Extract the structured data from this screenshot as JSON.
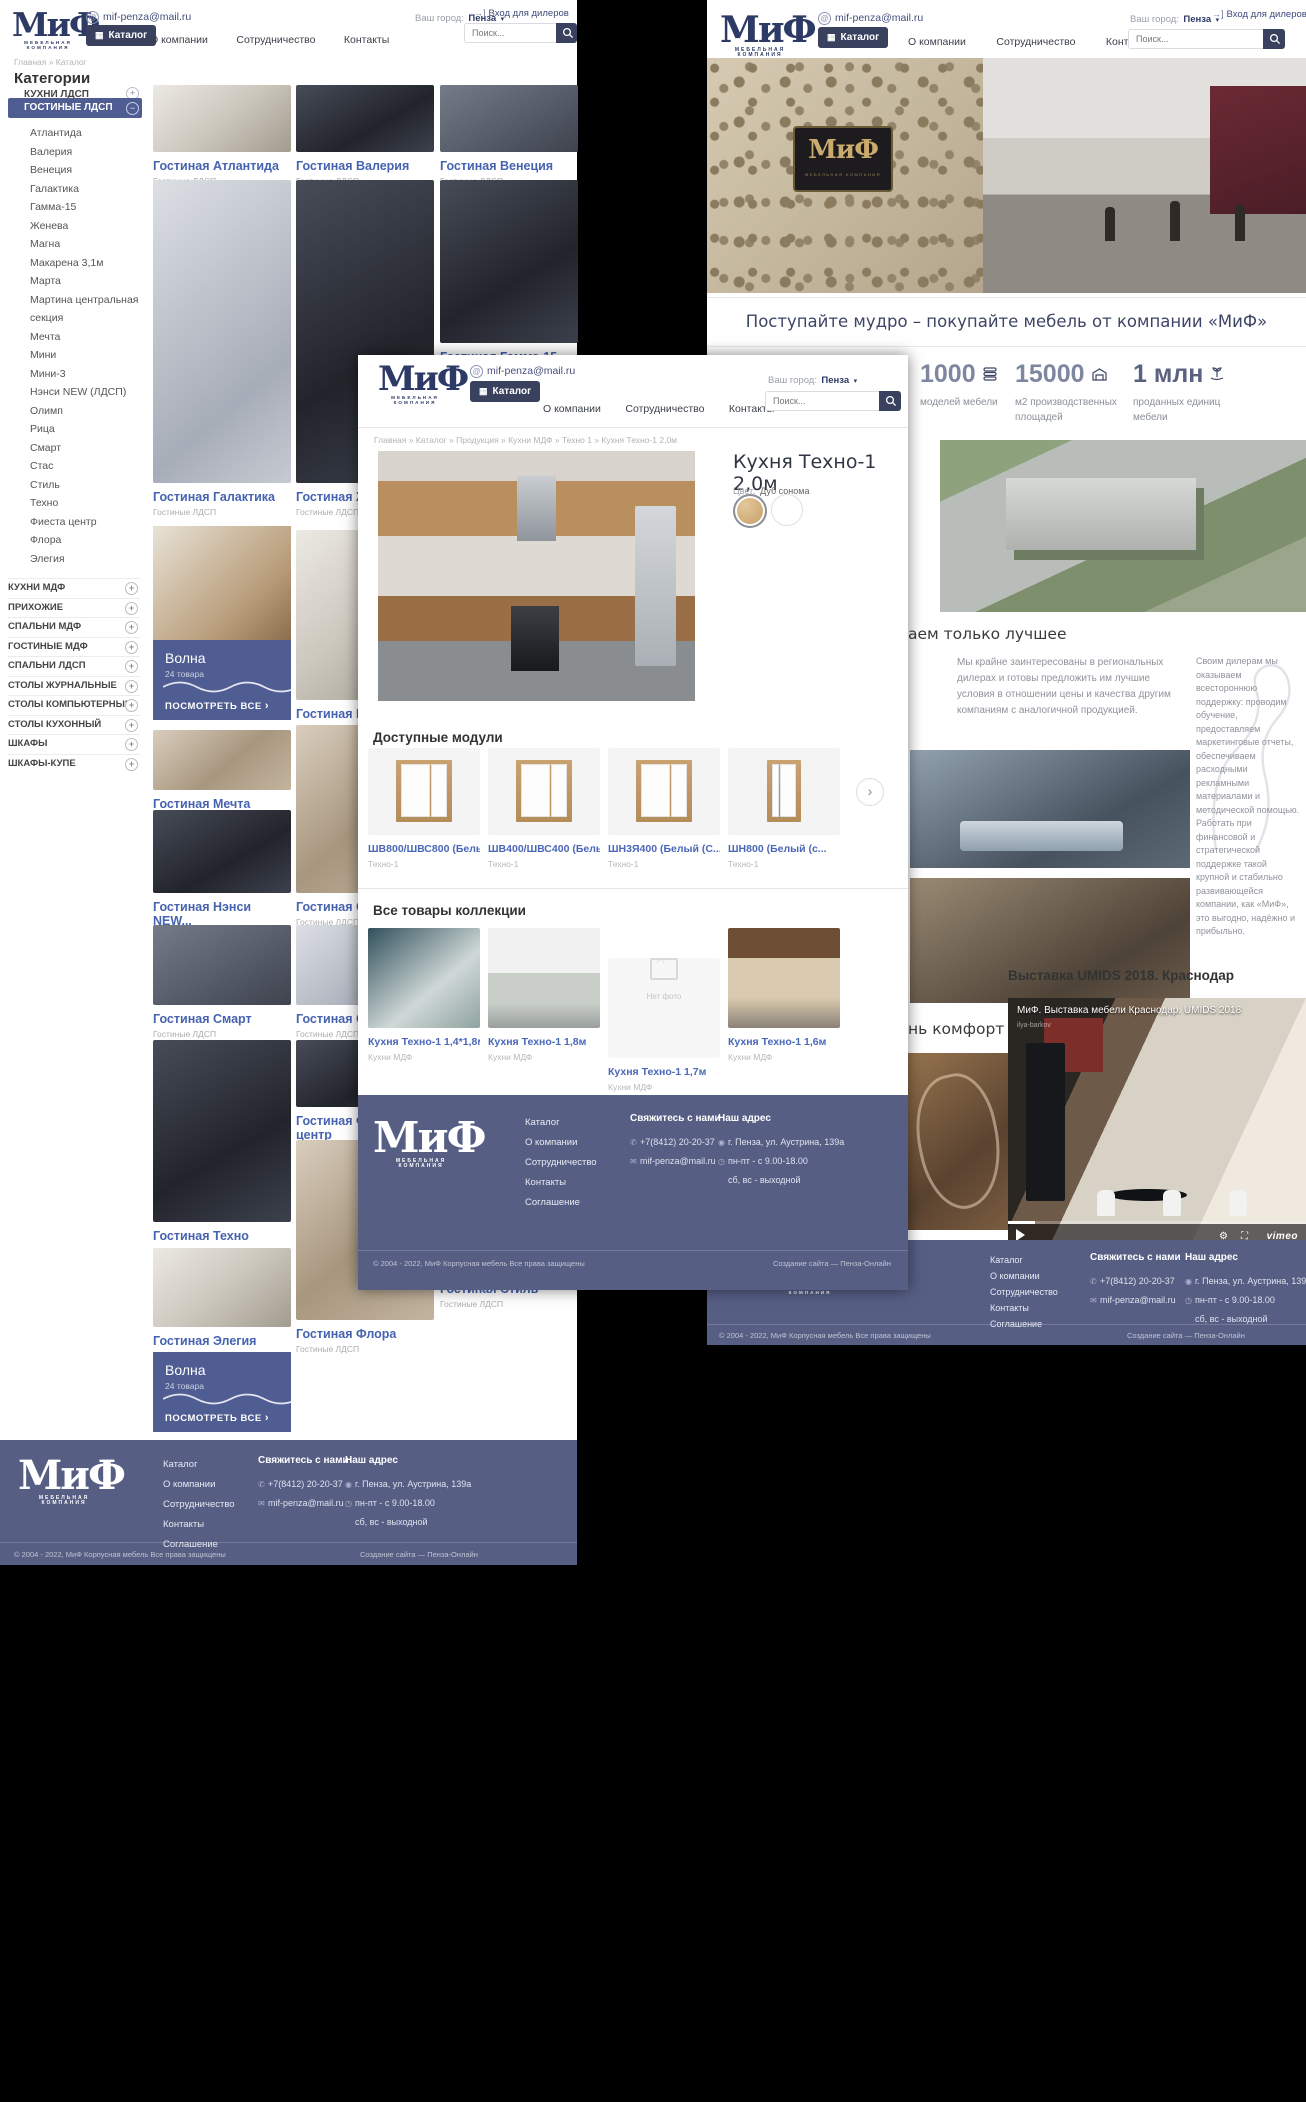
{
  "shared": {
    "logo": {
      "word": "МиФ",
      "sub": "МЕБЕЛЬНАЯ  КОМПАНИЯ"
    },
    "header": {
      "email": "mif-penza@mail.ru",
      "catalog_button": "Каталог",
      "nav": [
        "О компании",
        "Сотрудничество",
        "Контакты"
      ],
      "city_label": "Ваш город:",
      "city": "Пенза",
      "dealers_link": "Вход для дилеров",
      "search_placeholder": "Поиск..."
    },
    "footer": {
      "links": [
        "Каталог",
        "О компании",
        "Сотрудничество",
        "Контакты",
        "Соглашение"
      ],
      "contact_heading": "Свяжитесь с нами",
      "phone": "+7(8412) 20-20-37",
      "email": "mif-penza@mail.ru",
      "address_heading": "Наш адрес",
      "address": "г. Пенза, ул. Аустрина, 139а",
      "hours1": "пн-пт - с 9.00-18.00",
      "hours2": "сб, вс - выходной",
      "copyright": "© 2004 - 2022, МиФ Корпусная мебель Все права защищены",
      "credits": "Создание сайта — Пенза-Онлайн"
    }
  },
  "catalog_page": {
    "breadcrumb": "Главная » Каталог",
    "title": "Категории",
    "sidebar": {
      "first_item": "КУХНИ ЛДСП",
      "selected_item": "ГОСТИНЫЕ ЛДСП",
      "sub_items": [
        "Атлантида",
        "Валерия",
        "Венеция",
        "Галактика",
        "Гамма-15",
        "Женева",
        "Магна",
        "Макарена 3,1м",
        "Марта",
        "Мартина центральная секция",
        "Мечта",
        "Мини",
        "Мини-3",
        "Нэнси NEW (ЛДСП)",
        "Олимп",
        "Рица",
        "Смарт",
        "Стас",
        "Стиль",
        "Техно",
        "Фиеста центр",
        "Флора",
        "Элегия"
      ],
      "accordion_items": [
        "КУХНИ МДФ",
        "ПРИХОЖИЕ",
        "СПАЛЬНИ МДФ",
        "ГОСТИНЫЕ МДФ",
        "СПАЛЬНИ ЛДСП",
        "СТОЛЫ ЖУРНАЛЬНЫЕ",
        "СТОЛЫ КОМПЬЮТЕРНЫЕ",
        "СТОЛЫ КУХОННЫЙ",
        "ШКАФЫ",
        "ШКАФЫ-КУПЕ"
      ]
    },
    "col1": [
      {
        "name": "Гостиная Атлантида",
        "cat": "Гостиные ЛДСП",
        "top": 0,
        "h": 67,
        "ph": "ph-c"
      },
      {
        "name": "Гостиная Галактика",
        "cat": "Гостиные ЛДСП",
        "top": 95,
        "h": 303,
        "ph": "ph-f"
      },
      {
        "name": "Гостиная Мечта",
        "cat": "Гостиные ЛДСП",
        "top": 645,
        "h": 60,
        "ph": "ph-a"
      },
      {
        "name": "Гостиная Нэнси NEW...",
        "cat": "Гостиные ЛДСП",
        "top": 725,
        "h": 83,
        "ph": "ph-b"
      },
      {
        "name": "Гостиная Смарт",
        "cat": "Гостиные ЛДСП",
        "top": 840,
        "h": 80,
        "ph": "ph-d"
      },
      {
        "name": "Гостиная Техно",
        "cat": "Гостиные ЛДСП",
        "top": 955,
        "h": 182,
        "ph": "ph-b"
      },
      {
        "name": "Гостиная Элегия",
        "cat": "Гостиные ЛДСП",
        "top": 1163,
        "h": 79,
        "ph": "ph-c"
      }
    ],
    "col2": [
      {
        "name": "Гостиная Валерия",
        "cat": "Гостиные ЛДСП",
        "top": 0,
        "h": 67,
        "ph": "ph-b"
      },
      {
        "name": "Гостиная Женева",
        "cat": "Гостиные ЛДСП",
        "top": 95,
        "h": 303,
        "ph": "ph-b"
      },
      {
        "name": "Гостиная Магна",
        "cat": "Гостиные ЛДСП",
        "top": 445,
        "h": 170,
        "ph": "ph-c"
      },
      {
        "name": "Гостиная Олимп",
        "cat": "Гостиные ЛДСП",
        "top": 640,
        "h": 168,
        "ph": "ph-a"
      },
      {
        "name": "Гостиная Стас",
        "cat": "Гостиные ЛДСП",
        "top": 840,
        "h": 80,
        "ph": "ph-f"
      },
      {
        "name": "Гостиная Фиеста центр",
        "cat": "Гостиные ЛДСП",
        "top": 955,
        "h": 67,
        "ph": "ph-b"
      },
      {
        "name": "Гостиная Флора",
        "cat": "Гостиные ЛДСП",
        "top": 1055,
        "h": 180,
        "ph": "ph-a"
      }
    ],
    "col3": [
      {
        "name": "Гостиная Венеция",
        "cat": "Гостиные ЛДСП",
        "top": 0,
        "h": 67,
        "ph": "ph-d"
      },
      {
        "name": "Гостиная Гамма-15",
        "cat": "Гостиные ЛДСП",
        "top": 95,
        "h": 163,
        "ph": "ph-b"
      },
      {
        "name": "Гостиная Макарена 3,1м",
        "cat": "Гостиные ЛДСП",
        "top": 293,
        "h": 120,
        "ph": "ph-c"
      },
      {
        "name": "Гостиная Марта",
        "cat": "Гостиные ЛДСП",
        "top": 440,
        "h": 150,
        "ph": "ph-a"
      },
      {
        "name": "Гостиная Мини",
        "cat": "Гостиные ЛДСП",
        "top": 620,
        "h": 140,
        "ph": "ph-f"
      },
      {
        "name": "Гостиная Мини-3",
        "cat": "Гостиные ЛДСП",
        "top": 790,
        "h": 140,
        "ph": "ph-c"
      },
      {
        "name": "Гостиная Рица",
        "cat": "Гостиные ЛДСП",
        "top": 960,
        "h": 140,
        "ph": "ph-b"
      },
      {
        "name": "Гостиная Стиль",
        "cat": "Гостиные ЛДСП",
        "top": 1130,
        "h": 60,
        "ph": "ph-d"
      }
    ],
    "promo": {
      "title": "Волна",
      "count": "24 товара",
      "cta": "ПОСМОТРЕТЬ ВСЕ",
      "cta_arrow": "›"
    }
  },
  "home_page": {
    "headline": "Поступайте мудро – покупайте мебель от компании «МиФ»",
    "stats": [
      {
        "value": "1000",
        "label": "моделей мебели"
      },
      {
        "value": "15000",
        "label": "м2 производственных площадей"
      },
      {
        "value": "1 млн",
        "label": "проданных единиц мебели"
      }
    ],
    "section1_heading_visible": "аем только лучшее",
    "para1": "Мы крайне заинтересованы в региональных дилерах и готовы предложить им лучшие условия в отношении цены и качества другим компаниям с аналогичной продукцией.",
    "para2": "Своим дилерам мы оказываем всестороннюю поддержку: проводим обучение, предоставляем маркетинговые отчеты, обеспечиваем расходными рекламными материалами и методической помощью. Работать при финансовой и стратегической поддержке такой крупной и стабильно развивающейся компании, как «МиФ», это выгодно, надёжно и прибыльно.",
    "section2_heading_visible": "нь комфортной, красивой и уютной!",
    "video_heading": "Выставка UMIDS 2018. Краснодар",
    "video_title": "МиФ. Выставка мебели Краснодар. UMIDS 2018",
    "video_watermark": "ilya-barkov",
    "vimeo_label": "vimeo"
  },
  "product_page": {
    "breadcrumb": "Главная » Каталог » Продукция » Кухни МДФ » Техно 1 » Кухня Техно-1 2,0м",
    "title": "Кухня Техно-1 2,0м",
    "color_label": "Цвет:",
    "color_value": "Дуб сонома",
    "modules_heading": "Доступные модули",
    "modules": [
      {
        "name": "ШВ800/ШВС800 (Белый (...",
        "cat": "Техно-1"
      },
      {
        "name": "ШВ400/ШВС400 (Белый (...",
        "cat": "Техно-1"
      },
      {
        "name": "ШН3Я400 (Белый (С...",
        "cat": "Техно-1"
      },
      {
        "name": "ШН800 (Белый (с...",
        "cat": "Техно-1"
      }
    ],
    "collection_heading": "Все товары коллекции",
    "collection": [
      {
        "name": "Кухня Техно-1 1,4*1,8м",
        "cat": "Кухни МДФ"
      },
      {
        "name": "Кухня Техно-1 1,8м",
        "cat": "Кухни МДФ"
      },
      {
        "name": "Кухня Техно-1 1,7м",
        "cat": "Кухни МДФ"
      },
      {
        "name": "Кухня Техно-1 1,6м",
        "cat": "Кухни МДФ"
      }
    ],
    "no_photo": "Нет фото",
    "next_arrow": "›"
  }
}
